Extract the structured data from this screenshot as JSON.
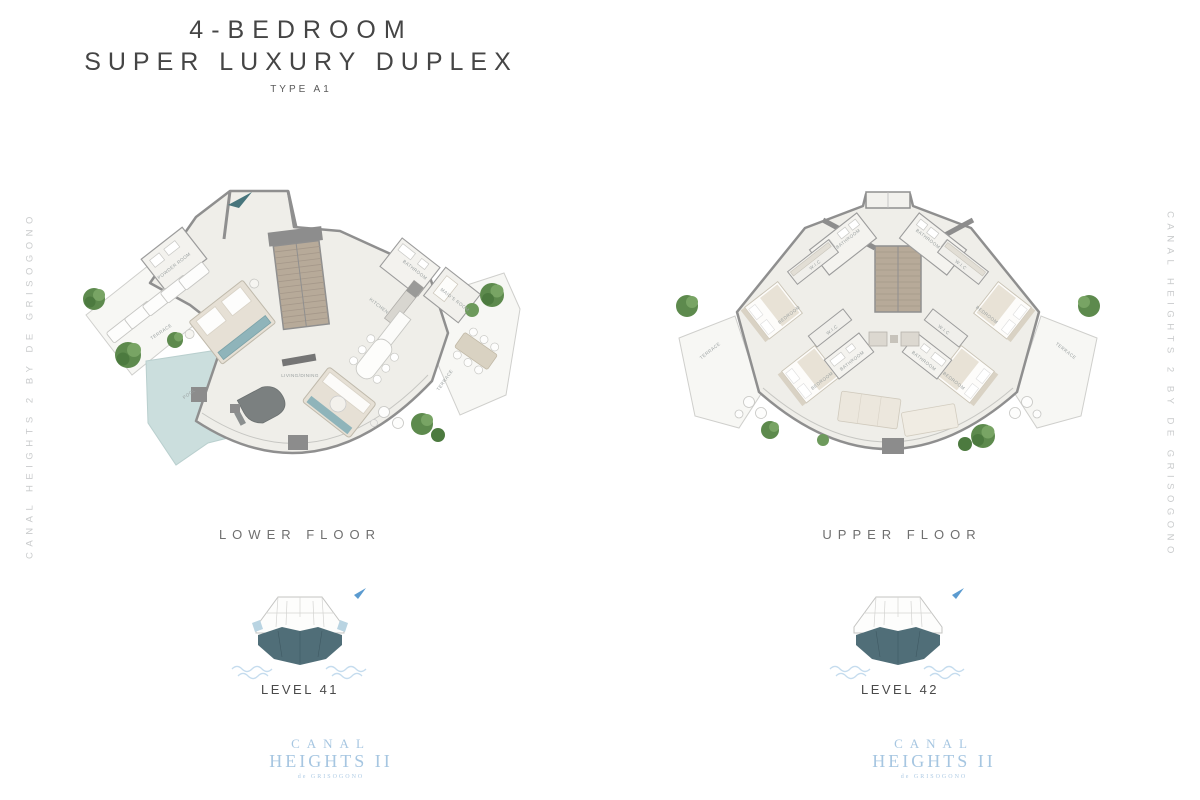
{
  "title": {
    "line1": "4-BEDROOM",
    "line2": "SUPER LUXURY DUPLEX",
    "type_label": "TYPE A1"
  },
  "watermark": {
    "left": "CANAL HEIGHTS 2 BY DE GRISOGONO",
    "right": "CANAL HEIGHTS 2 BY DE GRISOGONO"
  },
  "lower_floor": {
    "heading": "LOWER FLOOR",
    "level": "LEVEL 41",
    "rooms": {
      "powder_room": "POWDER ROOM",
      "terrace_left": "TERRACE",
      "pool": "POOL",
      "living_dining": "LIVING/DINING",
      "kitchen": "KITCHEN",
      "bathroom": "BATHROOM",
      "maids_room": "MAID'S ROOM",
      "terrace_right": "TERRACE"
    }
  },
  "upper_floor": {
    "heading": "UPPER FLOOR",
    "level": "LEVEL 42",
    "rooms": {
      "terrace_left": "TERRACE",
      "bathroom_left_top": "BATHROOM",
      "wic_left_top": "W.I.C",
      "bedroom_left_top": "BEDROOM",
      "wic_left_bottom": "W.I.C",
      "bedroom_left_bottom": "BEDROOM",
      "bathroom_left_mid": "BATHROOM",
      "bathroom_right_top": "BATHROOM",
      "wic_right_top": "W.I.C",
      "bedroom_right_top": "BEDROOM",
      "wic_right_bottom": "W.I.C",
      "bedroom_right_bottom": "BEDROOM",
      "bathroom_right_mid": "BATHROOM",
      "terrace_right": "TERRACE"
    }
  },
  "logo": {
    "line1": "CANAL",
    "line2": "HEIGHTS II",
    "subtitle": "de GRISOGONO"
  },
  "colors": {
    "title_gray": "#454545",
    "watermark_gray": "#c9cbcc",
    "wall_gray": "#8f8f8f",
    "floor_beige": "#efeee9",
    "terrace_white": "#f7f7f4",
    "pool_aqua": "#cbdedd",
    "stair_tan": "#b7aa99",
    "teal_accent": "#8fb4ba",
    "tree_green": "#5d8a4d",
    "logo_blue": "#a6c6e1",
    "minimap_highlight": "#506e78",
    "north_arrow_blue": "#5b9bd0"
  }
}
